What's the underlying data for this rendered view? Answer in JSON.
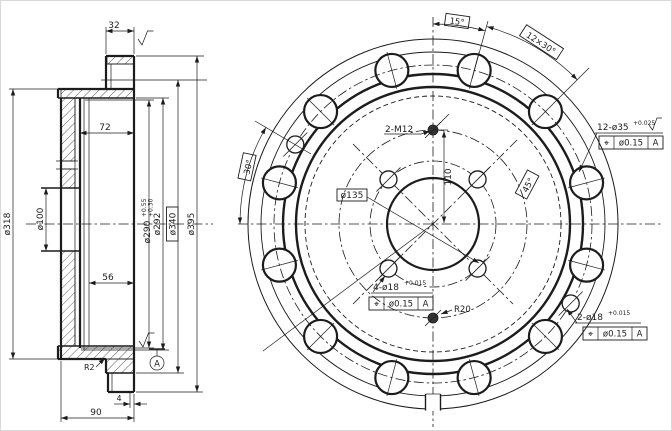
{
  "drawing": {
    "ink": "#1c1c1c",
    "background": "#ffffff",
    "left_view": {
      "d32": "32",
      "d72": "72",
      "d56": "56",
      "d4": "4",
      "d90": "90",
      "r2": "R2",
      "dia318": "ø318",
      "dia100": "ø100",
      "dia290": "ø290",
      "dia290_tol_upper": "+0.55",
      "dia290_tol_lower": "+0.30",
      "dia292": "ø292",
      "dia340": "ø340",
      "dia395": "ø395",
      "datum_label": "A"
    },
    "right_view": {
      "angle15": "15°",
      "spacing": "12×30°",
      "angle30": "30°",
      "angle45": "45°",
      "thread_callout": "2-M12",
      "radius110": "110",
      "bolt_circle_135": "ø135",
      "radius20": "R20",
      "holes12_callout": "12-ø35",
      "holes12_tol": "+0.025",
      "holes4_callout": "4-ø18",
      "holes4_tol": "+0.015",
      "holes2_callout": "2-ø18",
      "holes2_tol": "+0.015",
      "fcf": {
        "symbol": "⌖",
        "tolerance": "ø0.15",
        "datum": "A"
      }
    }
  }
}
